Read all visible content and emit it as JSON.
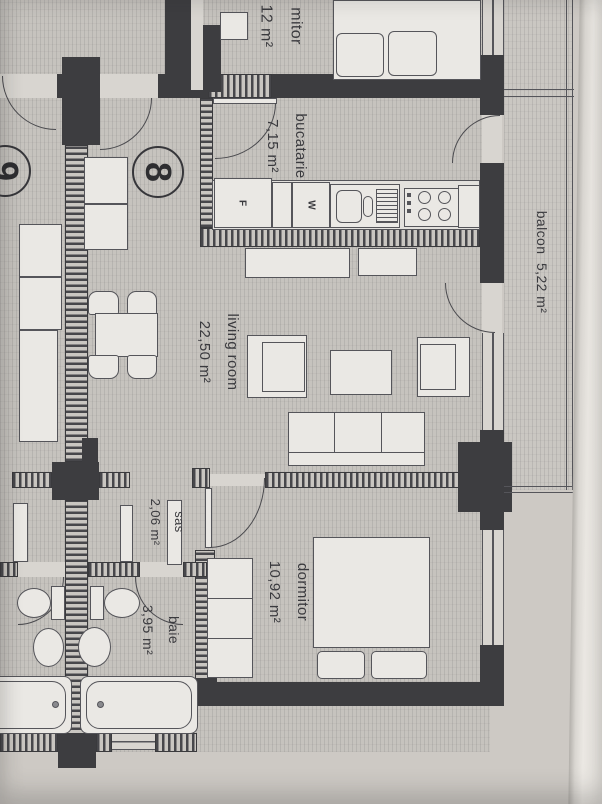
{
  "document": {
    "type": "apartment floor plan photo",
    "orientation": "rotated 90 degrees clockwise",
    "paper_color": "#cdc9c4",
    "ink_color": "#3d3d40"
  },
  "units": [
    {
      "number": "8"
    },
    {
      "number": "9"
    }
  ],
  "rooms": [
    {
      "name": "mitor",
      "area": "12 m²"
    },
    {
      "name": "bucatarie",
      "area": "7,15 m²"
    },
    {
      "name": "living room",
      "area": "22,50 m²"
    },
    {
      "name": "sas",
      "area": "2,06 m²"
    },
    {
      "name": "baie",
      "area": "3,95 m²"
    },
    {
      "name": "dormitor",
      "area": "10,92 m²"
    },
    {
      "name": "balcon",
      "area": "5,22 m²"
    }
  ],
  "appliances": {
    "fridge": "F",
    "washer": "W"
  }
}
